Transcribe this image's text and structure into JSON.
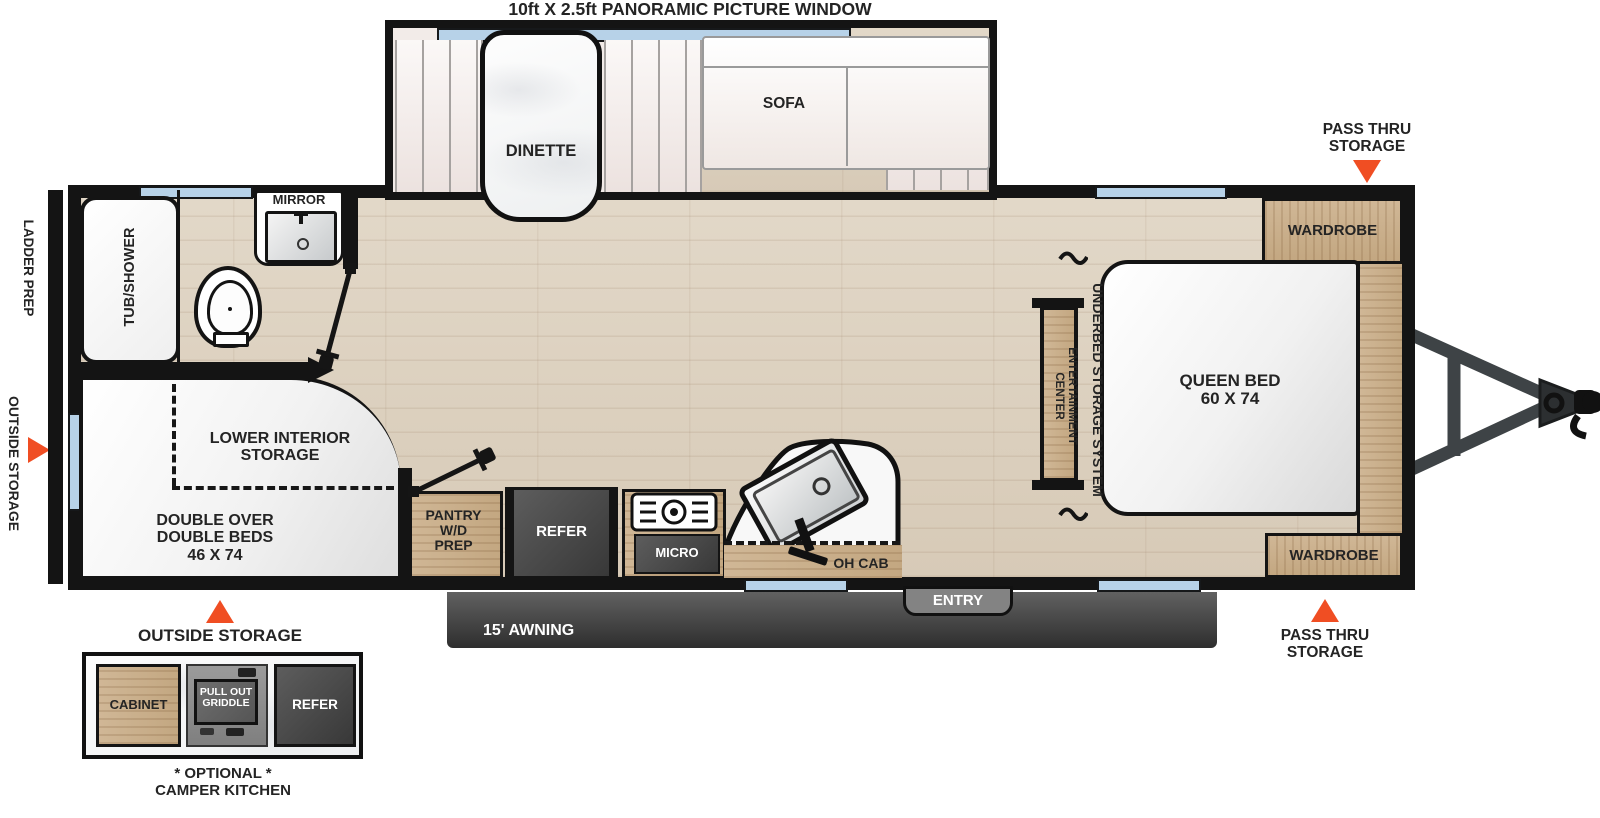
{
  "title": "10ft X 2.5ft PANORAMIC PICTURE WINDOW",
  "colors": {
    "accent_orange": "#F04E23",
    "window_blue": "#B7D2E8",
    "wall_black": "#141414",
    "cabinet_wood": "#C9AE8C",
    "appliance_gray": "#4A4A4A"
  },
  "slide_out": {
    "dinette_label": "DINETTE",
    "sofa_label": "SOFA"
  },
  "bedroom": {
    "wardrobe_front_label": "WARDROBE",
    "wardrobe_rear_label": "WARDROBE",
    "queen_bed_line1": "QUEEN BED",
    "queen_bed_line2": "60 X 74",
    "oh_shelf_label": "OH SHELF",
    "underbed_label": "UNDERBED STORAGE SYSTEM",
    "entertainment_line1": "ENTERTAINMENT",
    "entertainment_line2": "CENTER"
  },
  "bathroom": {
    "tub_label": "TUB/SHOWER",
    "mirror_label": "MIRROR"
  },
  "bunkroom": {
    "storage_line1": "LOWER INTERIOR",
    "storage_line2": "STORAGE",
    "beds_line1": "DOUBLE OVER",
    "beds_line2": "DOUBLE BEDS",
    "beds_line3": "46 X 74"
  },
  "kitchen": {
    "pantry_line1": "PANTRY",
    "pantry_line2": "W/D",
    "pantry_line3": "PREP",
    "refer_label": "REFER",
    "micro_label": "MICRO",
    "oh_cab_label": "OH CAB"
  },
  "exterior": {
    "pass_thru_line1": "PASS THRU",
    "pass_thru_line2": "STORAGE",
    "ladder_prep_label": "LADDER PREP",
    "outside_storage_side_label": "OUTSIDE STORAGE",
    "outside_storage_bottom_label": "OUTSIDE STORAGE",
    "entry_label": "ENTRY",
    "awning_label": "15' AWNING"
  },
  "camper_kitchen": {
    "cabinet_label": "CABINET",
    "griddle_line1": "PULL OUT",
    "griddle_line2": "GRIDDLE",
    "refer_label": "REFER",
    "optional_label": "* OPTIONAL *",
    "title_label": "CAMPER KITCHEN"
  }
}
